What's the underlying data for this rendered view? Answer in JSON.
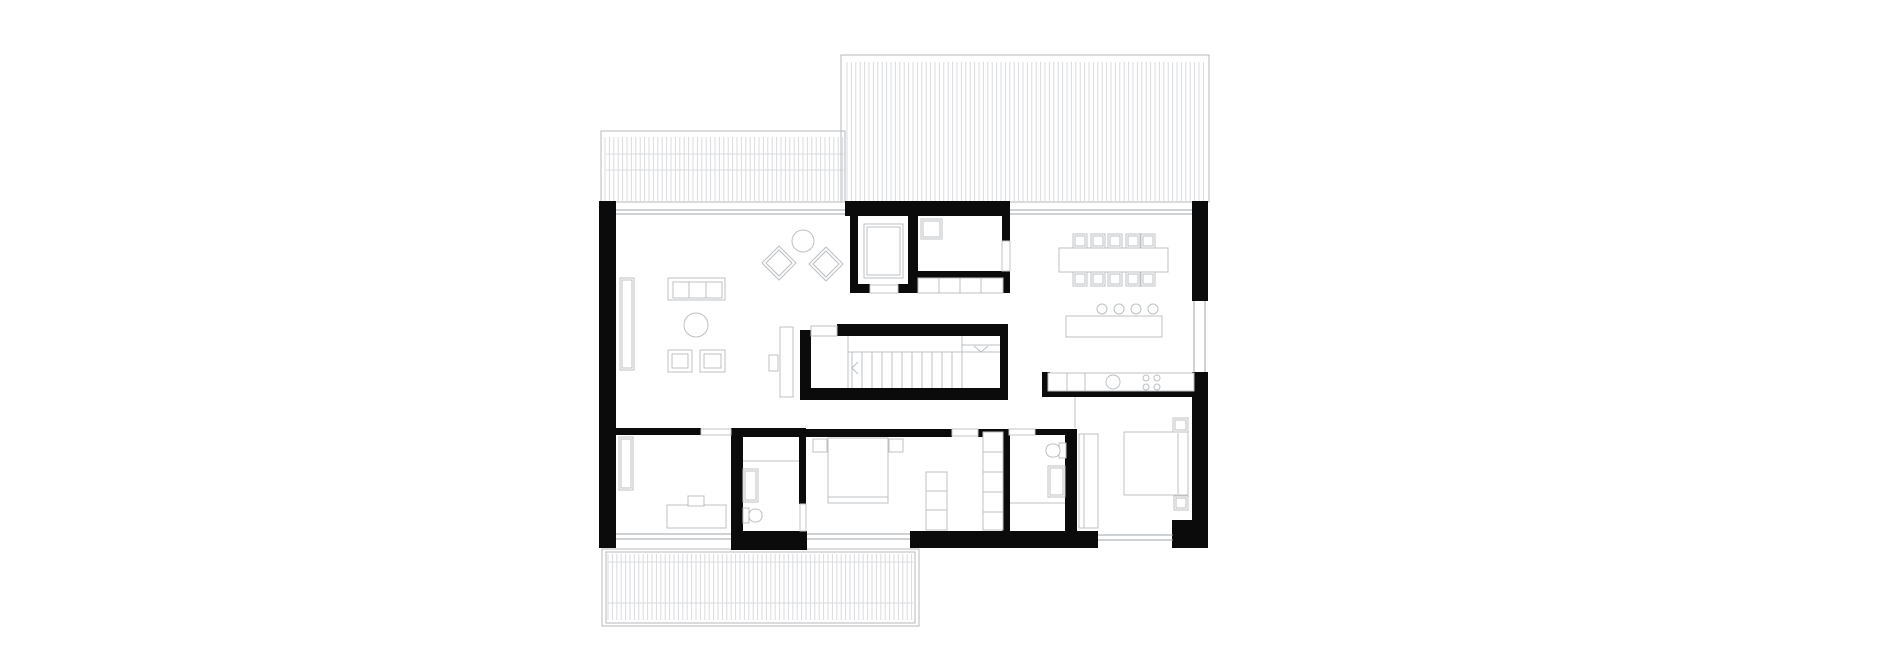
{
  "drawing": {
    "kind": "architectural-floor-plan",
    "width": 1880,
    "height": 662
  },
  "palette": {
    "wall": "#0b0b0b",
    "furniture": "#bcc0c3",
    "hatch": "#d9dbde",
    "deck_border": "#b5b8bb",
    "glass": "#9fa4a8",
    "door": "#c2c5c8",
    "floor": "#ffffff"
  },
  "decks": [
    {
      "n": "deck-top-left",
      "border": [
        [
          601,
          131,
          244,
          71
        ]
      ],
      "hatch": {
        "x": 605,
        "step": 4.4,
        "count": 55,
        "y1": 137,
        "y2": 201
      },
      "hlines": [
        [
          606,
          154,
          844
        ],
        [
          606,
          170,
          844
        ]
      ]
    },
    {
      "n": "deck-top-right",
      "border": [
        [
          841,
          55,
          368,
          147
        ]
      ],
      "hatch": {
        "x": 847,
        "step": 4.4,
        "count": 82,
        "y1": 62,
        "y2": 201
      },
      "hlines": []
    },
    {
      "n": "deck-bottom",
      "border": [
        [
          602,
          549,
          317,
          77
        ],
        [
          606,
          552,
          309,
          71
        ]
      ],
      "hatch": {
        "x": 608,
        "step": 4.4,
        "count": 70,
        "y1": 554,
        "y2": 620
      },
      "hlines": [
        [
          608,
          562,
          913
        ],
        [
          608,
          603,
          913
        ]
      ]
    }
  ],
  "walls": [
    {
      "n": "wall-exterior-left",
      "r": [
        599,
        201,
        17,
        347
      ]
    },
    {
      "n": "wall-core-top",
      "r": [
        845,
        201,
        165,
        15
      ]
    },
    {
      "n": "wall-exterior-right-upper",
      "r": [
        1192,
        201,
        16,
        100
      ]
    },
    {
      "n": "wall-exterior-right-lower",
      "r": [
        1192,
        372,
        16,
        176
      ]
    },
    {
      "n": "wall-exterior-bottom-right-corner",
      "r": [
        1172,
        520,
        24,
        28
      ]
    },
    {
      "n": "wall-bottom-center-left",
      "r": [
        731,
        531,
        76,
        19
      ]
    },
    {
      "n": "wall-bottom-center-right",
      "r": [
        910,
        531,
        188,
        17
      ]
    },
    {
      "n": "wall-core-left",
      "r": [
        850,
        206,
        8,
        87
      ]
    },
    {
      "n": "wall-core-middle",
      "r": [
        908,
        216,
        10,
        77
      ]
    },
    {
      "n": "wall-core-door-jamb-left",
      "r": [
        850,
        284,
        20,
        9
      ]
    },
    {
      "n": "wall-core-door-jamb-right",
      "r": [
        898,
        284,
        20,
        9
      ]
    },
    {
      "n": "wall-core-closet-back",
      "r": [
        918,
        271,
        85,
        7
      ]
    },
    {
      "n": "wall-core-right-upper",
      "r": [
        1002,
        216,
        8,
        25
      ]
    },
    {
      "n": "wall-core-right-lower",
      "r": [
        1002,
        271,
        8,
        22
      ]
    },
    {
      "n": "wall-stair-left",
      "r": [
        800,
        330,
        11,
        70
      ]
    },
    {
      "n": "wall-stair-top",
      "r": [
        837,
        324,
        171,
        12
      ]
    },
    {
      "n": "wall-stair-bottom",
      "r": [
        800,
        388,
        208,
        12
      ]
    },
    {
      "n": "wall-stair-right",
      "r": [
        1000,
        324,
        8,
        76
      ]
    },
    {
      "n": "wall-kitchen-stub",
      "r": [
        1042,
        372,
        8,
        25
      ]
    },
    {
      "n": "wall-kitchen-counter",
      "r": [
        1042,
        391,
        152,
        6
      ]
    },
    {
      "n": "wall-bedrooms-top-left",
      "r": [
        615,
        428,
        86,
        7
      ]
    },
    {
      "n": "wall-office-bath1",
      "r": [
        731,
        428,
        12,
        110
      ]
    },
    {
      "n": "wall-bath1-top",
      "r": [
        743,
        428,
        62,
        9
      ]
    },
    {
      "n": "wall-bath1-master",
      "r": [
        799,
        428,
        7,
        76
      ]
    },
    {
      "n": "wall-master-top-left",
      "r": [
        806,
        429,
        146,
        8
      ]
    },
    {
      "n": "wall-master-top-right",
      "r": [
        978,
        429,
        31,
        8
      ]
    },
    {
      "n": "wall-master-bath2",
      "r": [
        1002,
        429,
        8,
        104
      ]
    },
    {
      "n": "wall-bath2-top",
      "r": [
        1035,
        429,
        42,
        6
      ]
    },
    {
      "n": "wall-bath2-bed2",
      "r": [
        1065,
        429,
        12,
        104
      ]
    }
  ],
  "windows": [
    {
      "n": "window-living-top",
      "o": "h",
      "x": 616,
      "y": 210,
      "len": 229,
      "gap": 4
    },
    {
      "n": "window-dining-top",
      "o": "h",
      "x": 1010,
      "y": 210,
      "len": 182,
      "gap": 4
    },
    {
      "n": "window-kitchen-right",
      "o": "v",
      "x": 1194,
      "y": 301,
      "len": 71,
      "gap": 11
    },
    {
      "n": "window-office-bottom",
      "o": "h",
      "x": 616,
      "y": 534,
      "len": 115,
      "gap": 5
    },
    {
      "n": "window-master-bottom",
      "o": "h",
      "x": 807,
      "y": 534,
      "len": 103,
      "gap": 5
    },
    {
      "n": "window-bed2-bottom",
      "o": "h",
      "x": 1098,
      "y": 535,
      "len": 75,
      "gap": 5
    }
  ],
  "doors": [
    {
      "n": "door-office",
      "r": [
        701,
        429,
        30,
        6
      ]
    },
    {
      "n": "door-master-bedroom",
      "r": [
        952,
        429,
        26,
        7
      ]
    },
    {
      "n": "door-bath2",
      "r": [
        1009,
        429,
        26,
        6
      ]
    },
    {
      "n": "door-bath1",
      "r": [
        800,
        504,
        6,
        27
      ]
    },
    {
      "n": "door-core-wc",
      "r": [
        870,
        285,
        28,
        8
      ]
    },
    {
      "n": "opening-core-right",
      "r": [
        1002,
        241,
        8,
        30
      ]
    }
  ],
  "stairs": [
    {
      "t": "rect",
      "n": "stair-landing-notch",
      "r": [
        811,
        326,
        26,
        10
      ]
    },
    {
      "t": "line",
      "n": "stair-landing-edge",
      "p": [
        848,
        336,
        848,
        388
      ]
    },
    {
      "t": "line",
      "n": "stair-flight-divider",
      "p": [
        848,
        352,
        1000,
        352
      ]
    },
    {
      "t": "line",
      "n": "stair-upper-edge",
      "p": [
        962,
        336,
        962,
        388
      ]
    },
    {
      "t": "line",
      "n": "stair-upper-divider",
      "p": [
        962,
        345,
        1000,
        345
      ]
    },
    {
      "t": "vlines",
      "n": "stair-treads",
      "x": 852,
      "step": 10,
      "count": 12,
      "y1": 352,
      "y2": 388
    },
    {
      "t": "pline",
      "n": "stair-direction-chevron-left",
      "p": [
        858,
        362,
        852,
        368,
        858,
        374
      ]
    },
    {
      "t": "pline",
      "n": "stair-direction-chevron-right",
      "p": [
        974,
        346,
        981,
        352,
        988,
        346
      ]
    }
  ],
  "furniture": [
    {
      "t": "rect2",
      "n": "living-sideboard",
      "r": [
        620,
        278,
        14,
        92
      ],
      "i": 2
    },
    {
      "t": "rect",
      "n": "sofa",
      "r": [
        668,
        278,
        57,
        22
      ]
    },
    {
      "t": "rect",
      "n": "sofa-seat-1",
      "r": [
        673,
        282,
        16,
        16
      ]
    },
    {
      "t": "rect",
      "n": "sofa-seat-2",
      "r": [
        689,
        282,
        17,
        16
      ]
    },
    {
      "t": "rect",
      "n": "sofa-seat-3",
      "r": [
        706,
        282,
        16,
        16
      ]
    },
    {
      "t": "circle",
      "n": "coffee-table",
      "c": [
        696,
        325
      ],
      "rad": 12
    },
    {
      "t": "rect2",
      "n": "armchair-pouf-1",
      "r": [
        668,
        350,
        24,
        22
      ],
      "i": 4
    },
    {
      "t": "rect2",
      "n": "armchair-pouf-2",
      "r": [
        700,
        350,
        25,
        22
      ],
      "i": 4
    },
    {
      "t": "diamond",
      "n": "lounge-chair-1",
      "c": [
        779,
        263
      ],
      "rad": 17,
      "i": 4
    },
    {
      "t": "diamond",
      "n": "lounge-chair-2",
      "c": [
        826,
        264
      ],
      "rad": 17,
      "i": 4
    },
    {
      "t": "circle",
      "n": "lounge-side-table",
      "c": [
        803,
        241
      ],
      "rad": 11
    },
    {
      "t": "rect2",
      "n": "elevator-cab",
      "r": [
        864,
        224,
        39,
        54
      ],
      "i": 3
    },
    {
      "t": "rect2",
      "n": "wc-washbasin",
      "r": [
        921,
        219,
        21,
        20
      ],
      "i": 2
    },
    {
      "t": "rect",
      "n": "hall-closet",
      "r": [
        918,
        278,
        85,
        15
      ]
    },
    {
      "t": "line",
      "n": "hall-closet-divider-1",
      "p": [
        939,
        278,
        939,
        293
      ]
    },
    {
      "t": "line",
      "n": "hall-closet-divider-2",
      "p": [
        960,
        278,
        960,
        293
      ]
    },
    {
      "t": "line",
      "n": "hall-closet-divider-3",
      "p": [
        981,
        278,
        981,
        293
      ]
    },
    {
      "t": "rect",
      "n": "stair-side-cabinet",
      "r": [
        780,
        327,
        13,
        70
      ]
    },
    {
      "t": "rect",
      "n": "stair-side-table",
      "r": [
        769,
        355,
        9,
        16
      ]
    },
    {
      "t": "rect",
      "n": "dining-table",
      "r": [
        1059,
        248,
        109,
        24
      ]
    },
    {
      "t": "rect2",
      "n": "dining-chair-top-1",
      "r": [
        1073,
        234,
        14,
        14
      ],
      "i": 2
    },
    {
      "t": "rect2",
      "n": "dining-chair-top-2",
      "r": [
        1091,
        234,
        14,
        14
      ],
      "i": 2
    },
    {
      "t": "rect2",
      "n": "dining-chair-top-3",
      "r": [
        1108,
        234,
        14,
        14
      ],
      "i": 2
    },
    {
      "t": "rect2",
      "n": "dining-chair-top-4",
      "r": [
        1126,
        234,
        14,
        14
      ],
      "i": 2
    },
    {
      "t": "rect2",
      "n": "dining-chair-top-5",
      "r": [
        1141,
        234,
        14,
        14
      ],
      "i": 2
    },
    {
      "t": "rect2",
      "n": "dining-chair-bottom-1",
      "r": [
        1073,
        272,
        14,
        14
      ],
      "i": 2
    },
    {
      "t": "rect2",
      "n": "dining-chair-bottom-2",
      "r": [
        1091,
        272,
        14,
        14
      ],
      "i": 2
    },
    {
      "t": "rect2",
      "n": "dining-chair-bottom-3",
      "r": [
        1108,
        272,
        14,
        14
      ],
      "i": 2
    },
    {
      "t": "rect2",
      "n": "dining-chair-bottom-4",
      "r": [
        1126,
        272,
        14,
        14
      ],
      "i": 2
    },
    {
      "t": "rect2",
      "n": "dining-chair-bottom-5",
      "r": [
        1141,
        272,
        14,
        14
      ],
      "i": 2
    },
    {
      "t": "rect",
      "n": "kitchen-island",
      "r": [
        1066,
        316,
        96,
        21
      ]
    },
    {
      "t": "circle",
      "n": "bar-stool-1",
      "c": [
        1102,
        309
      ],
      "rad": 5
    },
    {
      "t": "circle",
      "n": "bar-stool-2",
      "c": [
        1119,
        309
      ],
      "rad": 5
    },
    {
      "t": "circle",
      "n": "bar-stool-3",
      "c": [
        1136,
        309
      ],
      "rad": 5
    },
    {
      "t": "circle",
      "n": "bar-stool-4",
      "c": [
        1153,
        309
      ],
      "rad": 5
    },
    {
      "t": "rect",
      "n": "kitchen-counter",
      "r": [
        1048,
        373,
        146,
        18
      ]
    },
    {
      "t": "line",
      "n": "kitchen-counter-divider-1",
      "p": [
        1067,
        373,
        1067,
        391
      ]
    },
    {
      "t": "line",
      "n": "kitchen-counter-divider-2",
      "p": [
        1085,
        373,
        1085,
        391
      ]
    },
    {
      "t": "circle",
      "n": "kitchen-sink",
      "c": [
        1113,
        382
      ],
      "rad": 7
    },
    {
      "t": "circle",
      "n": "hob-burner-1",
      "c": [
        1146,
        378
      ],
      "rad": 3
    },
    {
      "t": "circle",
      "n": "hob-burner-2",
      "c": [
        1157,
        378
      ],
      "rad": 3
    },
    {
      "t": "circle",
      "n": "hob-burner-3",
      "c": [
        1146,
        387
      ],
      "rad": 3
    },
    {
      "t": "circle",
      "n": "hob-burner-4",
      "c": [
        1157,
        387
      ],
      "rad": 3
    },
    {
      "t": "rect2",
      "n": "office-shelf",
      "r": [
        619,
        437,
        14,
        53
      ],
      "i": 2
    },
    {
      "t": "rect",
      "n": "office-desk",
      "r": [
        667,
        505,
        59,
        23
      ]
    },
    {
      "t": "rect",
      "n": "office-chair",
      "r": [
        688,
        496,
        16,
        10
      ]
    },
    {
      "t": "line",
      "n": "bath1-partition",
      "p": [
        743,
        461,
        799,
        461
      ]
    },
    {
      "t": "rect2",
      "n": "bath1-shower",
      "r": [
        743,
        469,
        15,
        33
      ],
      "i": 2
    },
    {
      "t": "rect",
      "n": "bath1-toilet-tank",
      "r": [
        743,
        508,
        6,
        15
      ]
    },
    {
      "t": "round",
      "n": "bath1-toilet-bowl",
      "r": [
        749,
        509,
        13,
        13
      ],
      "rx": 6
    },
    {
      "t": "rect",
      "n": "master-bed",
      "r": [
        828,
        438,
        60,
        65
      ]
    },
    {
      "t": "line",
      "n": "master-bed-foot-line",
      "p": [
        828,
        497,
        888,
        497
      ]
    },
    {
      "t": "rect",
      "n": "master-nightstand-left",
      "r": [
        813,
        439,
        14,
        13
      ]
    },
    {
      "t": "rect",
      "n": "master-nightstand-right",
      "r": [
        889,
        439,
        14,
        13
      ]
    },
    {
      "t": "rect",
      "n": "master-dresser",
      "r": [
        926,
        472,
        21,
        58
      ]
    },
    {
      "t": "line",
      "n": "master-dresser-divider-1",
      "p": [
        926,
        491,
        947,
        491
      ]
    },
    {
      "t": "line",
      "n": "master-dresser-divider-2",
      "p": [
        926,
        510,
        947,
        510
      ]
    },
    {
      "t": "rect",
      "n": "master-wardrobe",
      "r": [
        983,
        432,
        20,
        98
      ]
    },
    {
      "t": "line",
      "n": "master-wardrobe-divider-1",
      "p": [
        983,
        452,
        1003,
        452
      ]
    },
    {
      "t": "line",
      "n": "master-wardrobe-divider-2",
      "p": [
        983,
        472,
        1003,
        472
      ]
    },
    {
      "t": "line",
      "n": "master-wardrobe-divider-3",
      "p": [
        983,
        492,
        1003,
        492
      ]
    },
    {
      "t": "line",
      "n": "master-wardrobe-divider-4",
      "p": [
        983,
        512,
        1003,
        512
      ]
    },
    {
      "t": "rect",
      "n": "bath2-toilet-tank",
      "r": [
        1059,
        443,
        7,
        15
      ]
    },
    {
      "t": "round",
      "n": "bath2-toilet-bowl",
      "r": [
        1046,
        444,
        14,
        13
      ],
      "rx": 6
    },
    {
      "t": "rect2",
      "n": "bath2-shower",
      "r": [
        1048,
        466,
        17,
        31
      ],
      "i": 2
    },
    {
      "t": "line",
      "n": "bath2-partition",
      "p": [
        1010,
        503,
        1065,
        503
      ]
    },
    {
      "t": "rect",
      "n": "bedroom2-bed",
      "r": [
        1124,
        432,
        64,
        63
      ]
    },
    {
      "t": "line",
      "n": "bedroom2-bed-head-line",
      "p": [
        1178,
        433,
        1178,
        494
      ]
    },
    {
      "t": "rect2",
      "n": "bedroom2-nightstand-top",
      "r": [
        1173,
        418,
        15,
        14
      ],
      "i": 2
    },
    {
      "t": "rect2",
      "n": "bedroom2-nightstand-bottom",
      "r": [
        1174,
        496,
        14,
        14
      ],
      "i": 2
    },
    {
      "t": "rect",
      "n": "bedroom2-wardrobe",
      "r": [
        1079,
        434,
        19,
        94
      ]
    },
    {
      "t": "line",
      "n": "bedroom2-wardrobe-line",
      "p": [
        1084,
        434,
        1084,
        528
      ]
    }
  ],
  "lines": [
    {
      "n": "bedroom2-door-line",
      "p": [
        1075,
        397,
        1075,
        428
      ]
    }
  ]
}
